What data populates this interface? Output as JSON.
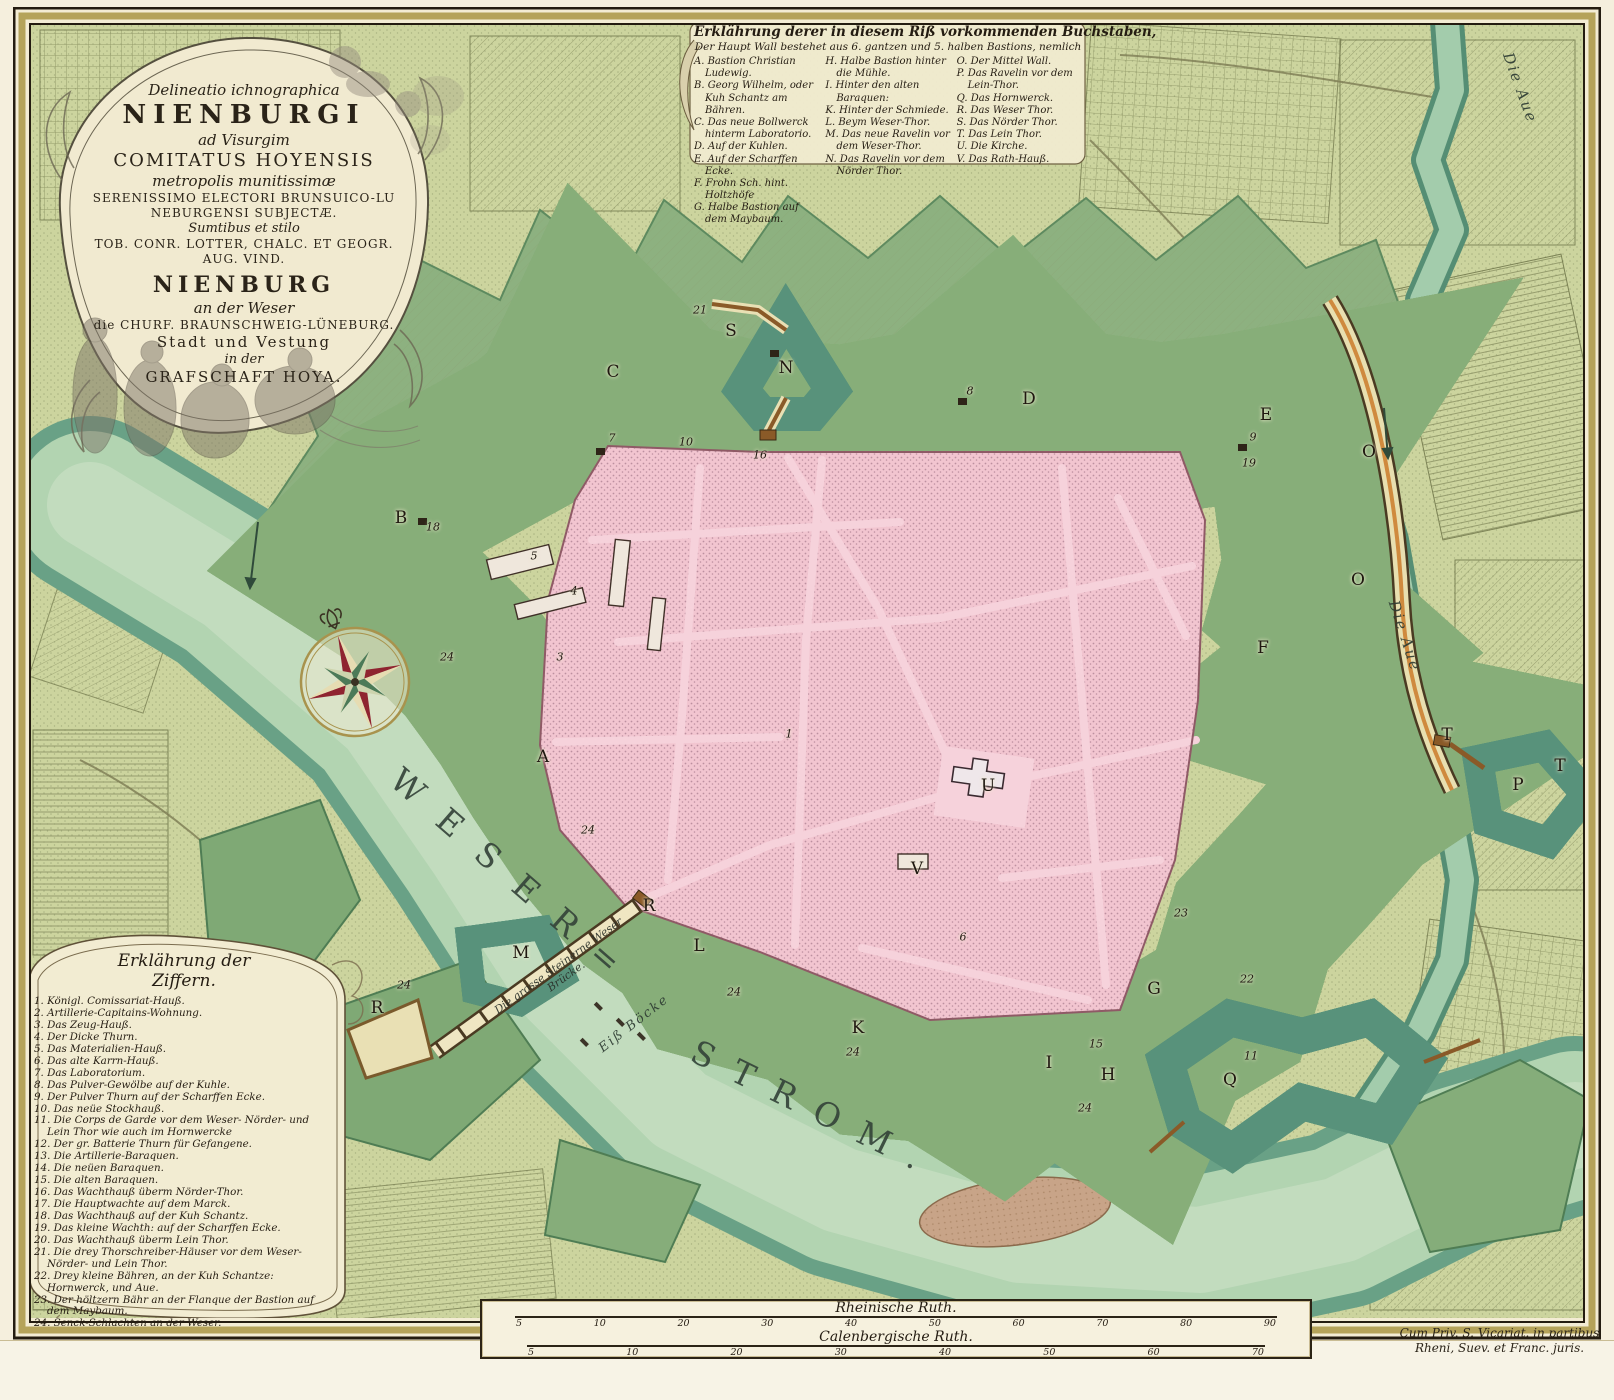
{
  "title_cartouche": {
    "lines": [
      "Delineatio ichnographica",
      "NIENBURGI",
      "ad Visurgim",
      "COMITATUS HOYENSIS",
      "metropolis munitissimæ",
      "SERENISSIMO ELECTORI BRUNSUICO-LU",
      "NEBURGENSI SUBJECTÆ.",
      "Sumtibus et stilo",
      "TOB. CONR. LOTTER, CHALC. ET GEOGR.",
      "AUG. VIND.",
      "NIENBURG",
      "an der Weser",
      "die CHURF. BRAUNSCHWEIG-LÜNEBURG.",
      "Stadt und Vestung",
      "in der",
      "GRAFSCHAFT HOYA."
    ]
  },
  "letters_legend": {
    "title": "Erklährung derer in diesem Riß vorkommenden Buchstaben,",
    "subtitle": "Der Haupt Wall bestehet aus 6. gantzen und 5. halben Bastions, nemlich",
    "col1": [
      "A. Bastion Christian Ludewig.",
      "B. Georg Wilhelm, oder Kuh Schantz am Bähren.",
      "C. Das neue Bollwerck hinterm Laboratorio.",
      "D. Auf der Kuhlen.",
      "E. Auf der Scharffen Ecke.",
      "F. Frohn Sch. hint. Holtzhöfe",
      "G. Halbe Bastion auf dem Maybaum."
    ],
    "col2": [
      "H. Halbe Bastion hinter die Mühle.",
      "I. Hinter den alten Baraquen:",
      "K. Hinter der Schmiede.",
      "L. Beym Weser-Thor.",
      "M. Das neue Ravelin vor dem Weser-Thor.",
      "N. Das Ravelin vor dem Nörder Thor."
    ],
    "col3": [
      "O. Der Mittel Wall.",
      "P. Das Ravelin vor dem Lein-Thor.",
      "Q. Das Hornwerck.",
      "R. Das Weser Thor.",
      "S. Das Nörder Thor.",
      "T. Das Lein Thor.",
      "U. Die Kirche.",
      "V. Das Rath-Hauß."
    ]
  },
  "numbers_legend": {
    "title_line1": "Erklährung der",
    "title_line2": "Ziffern.",
    "entries": [
      "1. Königl. Comissariat-Hauß.",
      "2. Artillerie-Capitains-Wohnung.",
      "3. Das Zeug-Hauß.",
      "4. Der Dicke Thurn.",
      "5. Das Materialien-Hauß.",
      "6. Das alte Karrn-Hauß.",
      "7. Das Laboratorium.",
      "8. Das Pulver-Gewölbe auf der Kuhle.",
      "9. Der Pulver Thurn auf der Scharffen Ecke.",
      "10. Das neüe Stockhauß.",
      "11. Die Corps de Garde vor dem Weser- Nörder- und Lein Thor wie auch im Hornwercke",
      "12. Der gr. Batterie Thurn für Gefangene.",
      "13. Die Artillerie-Baraquen.",
      "14. Die neüen Baraquen.",
      "15. Die alten Baraquen.",
      "16. Das Wachthauß überm Nörder-Thor.",
      "17. Die Hauptwachte auf dem Marck.",
      "18. Das Wachthauß auf der Kuh Schantz.",
      "19. Das kleine Wachth: auf der Scharffen Ecke.",
      "20. Das Wachthauß überm Lein Thor.",
      "21. Die drey Thorschreiber-Häuser vor dem Weser- Nörder- und Lein Thor.",
      "22. Drey kleine Bähren, an der Kuh Schantze: Hornwerck, und Aue.",
      "23. Der höltzern Bähr an der Flanque der Bastion auf dem Maybaum.",
      "24. Senck-Schlachten an der Weser."
    ]
  },
  "scale_panel": {
    "ruler1_label": "Rheinische Ruth.",
    "ruler1_ticks": [
      "5",
      "10",
      "20",
      "30",
      "40",
      "50",
      "60",
      "70",
      "80",
      "90"
    ],
    "ruler2_label": "Calenbergische Ruth.",
    "ruler2_ticks": [
      "5",
      "10",
      "20",
      "30",
      "40",
      "50",
      "60",
      "70"
    ]
  },
  "imprint": {
    "line1": "Cum Priv. S. Vicariat. in partibus",
    "line2": "Rheni, Suev. et Franc. juris."
  },
  "map_labels": {
    "weser": "WESER=",
    "strom": "STROM.",
    "aue_top": "Die Aue",
    "aue_mid": "Die Aue",
    "eisboecke": "Eiß Böcke",
    "bridge_line1": "Die grosse Steinerne Weser",
    "bridge_line2": "Brücke.",
    "letters": [
      {
        "t": "A",
        "x": 543,
        "y": 757
      },
      {
        "t": "B",
        "x": 401,
        "y": 518
      },
      {
        "t": "C",
        "x": 613,
        "y": 372
      },
      {
        "t": "D",
        "x": 1029,
        "y": 399
      },
      {
        "t": "E",
        "x": 1266,
        "y": 415
      },
      {
        "t": "F",
        "x": 1263,
        "y": 648
      },
      {
        "t": "G",
        "x": 1154,
        "y": 989
      },
      {
        "t": "H",
        "x": 1108,
        "y": 1075
      },
      {
        "t": "I",
        "x": 1049,
        "y": 1063
      },
      {
        "t": "K",
        "x": 858,
        "y": 1028
      },
      {
        "t": "L",
        "x": 699,
        "y": 946
      },
      {
        "t": "M",
        "x": 521,
        "y": 953
      },
      {
        "t": "N",
        "x": 786,
        "y": 368
      },
      {
        "t": "O",
        "x": 1369,
        "y": 452
      },
      {
        "t": "O",
        "x": 1358,
        "y": 580
      },
      {
        "t": "P",
        "x": 1518,
        "y": 785
      },
      {
        "t": "Q",
        "x": 1230,
        "y": 1080
      },
      {
        "t": "R",
        "x": 649,
        "y": 906
      },
      {
        "t": "R",
        "x": 377,
        "y": 1008
      },
      {
        "t": "S",
        "x": 731,
        "y": 331
      },
      {
        "t": "T",
        "x": 1447,
        "y": 735
      },
      {
        "t": "T",
        "x": 1560,
        "y": 766
      },
      {
        "t": "U",
        "x": 988,
        "y": 786
      },
      {
        "t": "V",
        "x": 917,
        "y": 869
      }
    ],
    "numbers": [
      {
        "t": "18",
        "x": 433,
        "y": 527
      },
      {
        "t": "7",
        "x": 612,
        "y": 438
      },
      {
        "t": "21",
        "x": 700,
        "y": 310
      },
      {
        "t": "10",
        "x": 686,
        "y": 442
      },
      {
        "t": "16",
        "x": 760,
        "y": 455
      },
      {
        "t": "8",
        "x": 970,
        "y": 391
      },
      {
        "t": "9",
        "x": 1253,
        "y": 437
      },
      {
        "t": "19",
        "x": 1249,
        "y": 463
      },
      {
        "t": "5",
        "x": 534,
        "y": 556
      },
      {
        "t": "4",
        "x": 574,
        "y": 591
      },
      {
        "t": "3",
        "x": 560,
        "y": 657
      },
      {
        "t": "1",
        "x": 789,
        "y": 734
      },
      {
        "t": "6",
        "x": 963,
        "y": 937
      },
      {
        "t": "15",
        "x": 1096,
        "y": 1044
      },
      {
        "t": "11",
        "x": 1251,
        "y": 1056
      },
      {
        "t": "22",
        "x": 1247,
        "y": 979
      },
      {
        "t": "23",
        "x": 1181,
        "y": 913
      },
      {
        "t": "24",
        "x": 447,
        "y": 657
      },
      {
        "t": "24",
        "x": 588,
        "y": 830
      },
      {
        "t": "24",
        "x": 734,
        "y": 992
      },
      {
        "t": "24",
        "x": 853,
        "y": 1052
      },
      {
        "t": "24",
        "x": 1085,
        "y": 1108
      },
      {
        "t": "24",
        "x": 404,
        "y": 985
      }
    ]
  },
  "colors": {
    "paper": "#f3ecd4",
    "countryside": "#ccd49e",
    "water": "#b2d4b1",
    "moat": "#a9cfaf",
    "glacis": "#87ae79",
    "rampart": "#f3ebc0",
    "wall_orange": "#d08a3c",
    "city_pink": "#f2c5d0",
    "block_mauve": "#c39aa9",
    "ink": "#241c10"
  }
}
